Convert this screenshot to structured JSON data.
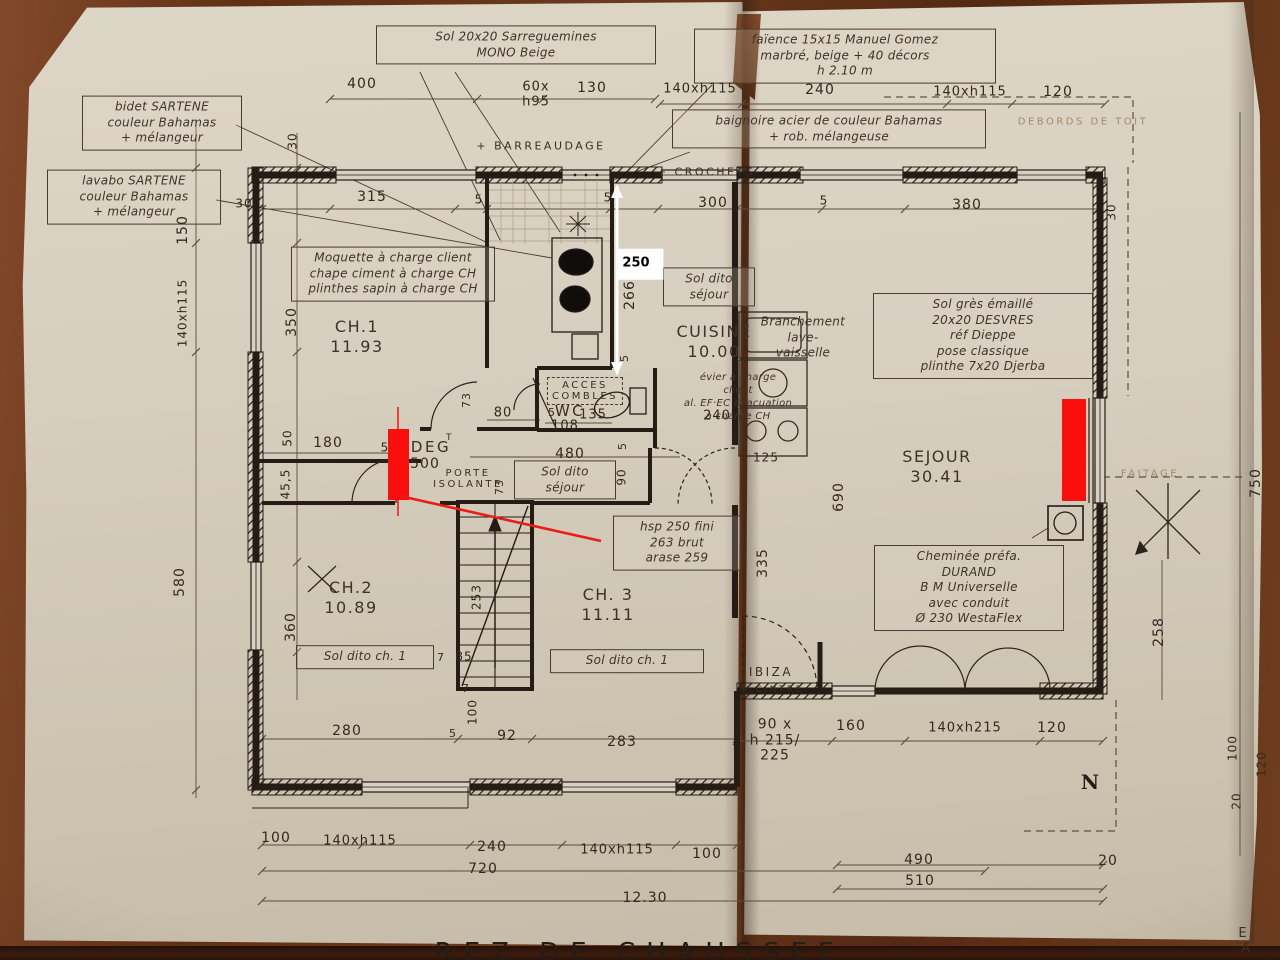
{
  "colors": {
    "ink": "#241c15",
    "paper": "#d6cebe",
    "wood": "#6b3a1d",
    "red": "#fb0f0c",
    "white": "#ffffff"
  },
  "labels": [
    {
      "t": "Sol 20x20  Sarreguemines\nMONO  Beige",
      "x": 516,
      "y": 45,
      "w": 268,
      "cls": "hand box",
      "n": "note-sol-sarreguemines"
    },
    {
      "t": "bidet  SARTENE\ncouleur  Bahamas\n+ mélangeur",
      "x": 162,
      "y": 123,
      "w": 148,
      "cls": "hand box",
      "n": "note-bidet"
    },
    {
      "t": "lavabo  SARTENE\ncouleur  Bahamas\n+ mélangeur",
      "x": 134,
      "y": 197,
      "w": 162,
      "cls": "hand box",
      "n": "note-lavabo"
    },
    {
      "t": "faïence  15x15   Manuel Gomez\nmarbré, beige   + 40 décors\nh 2.10 m",
      "x": 845,
      "y": 56,
      "w": 290,
      "cls": "hand box",
      "n": "note-faience"
    },
    {
      "t": "baignoire  acier  de couleur  Bahamas\n+ rob. mélangeuse",
      "x": 829,
      "y": 129,
      "w": 302,
      "cls": "hand box",
      "n": "note-baignoire"
    },
    {
      "t": "Moquette à charge client\nchape ciment à charge CH\nplinthes sapin à charge CH",
      "x": 393,
      "y": 274,
      "w": 192,
      "cls": "hand box",
      "n": "note-moquette"
    },
    {
      "t": "Sol dito\nséjour",
      "x": 709,
      "y": 287,
      "w": 80,
      "cls": "hand box",
      "n": "note-sol-dito-sejour-cuisine"
    },
    {
      "t": "Sol grès émaillé\n20x20  DESVRES\nréf  Dieppe\npose  classique\nplinthe  7x20  Djerba",
      "x": 983,
      "y": 336,
      "w": 208,
      "cls": "hand box",
      "n": "note-sol-gres"
    },
    {
      "t": "Cheminée  préfa.\nDURAND\nB M   Universelle\navec  conduit\nØ 230   WestaFlex",
      "x": 969,
      "y": 588,
      "w": 178,
      "cls": "hand box",
      "n": "note-cheminee"
    },
    {
      "t": "Sol dito\nséjour",
      "x": 565,
      "y": 480,
      "w": 90,
      "cls": "hand box",
      "n": "note-sol-dito-sejour-deg"
    },
    {
      "t": "Sol dito ch. 1",
      "x": 365,
      "y": 657,
      "w": 126,
      "cls": "hand box",
      "n": "note-sol-dito-ch2"
    },
    {
      "t": "Sol dito ch. 1",
      "x": 627,
      "y": 661,
      "w": 142,
      "cls": "hand box",
      "n": "note-sol-dito-ch3"
    },
    {
      "t": "hsp 250 fini\n263 brut\narase 259",
      "x": 677,
      "y": 543,
      "w": 116,
      "cls": "hand box",
      "n": "note-hauteurs"
    },
    {
      "t": "Branchement\nlave-\nvaisselle",
      "x": 803,
      "y": 338,
      "cls": "hand",
      "n": "note-lave-vaisselle"
    },
    {
      "t": "évier à charge\nclient\nal. EF·EC évacuation\nà charge CH",
      "x": 738,
      "y": 397,
      "cls": "hand",
      "fs": 10,
      "n": "note-evier"
    },
    {
      "t": "+ BARREAUDAGE",
      "x": 541,
      "y": 146,
      "cls": "print",
      "n": "note-barreaudage"
    },
    {
      "t": "+ CROCHETS",
      "x": 706,
      "y": 172,
      "cls": "print",
      "n": "note-crochets"
    },
    {
      "t": "ACCES\nCOMBLES",
      "x": 585,
      "y": 391,
      "cls": "print dashedbox",
      "fs": 10,
      "n": "note-acces-combles"
    },
    {
      "t": "WC",
      "x": 570,
      "y": 411,
      "cls": "print",
      "fs": 15,
      "n": "room-wc"
    },
    {
      "t": "DEG",
      "x": 431,
      "y": 447,
      "cls": "print",
      "fs": 15,
      "n": "room-deg"
    },
    {
      "t": "T",
      "x": 450,
      "y": 438,
      "cls": "print",
      "fs": 9,
      "n": "room-deg-sup"
    },
    {
      "t": "PORTE\nISOLANTE",
      "x": 468,
      "y": 479,
      "cls": "print",
      "fs": 10,
      "n": "note-porte-isolante"
    },
    {
      "t": "DEBORDS  DE  TOIT",
      "x": 1083,
      "y": 122,
      "cls": "print faint",
      "fs": 10,
      "n": "note-debords-de-toit"
    },
    {
      "t": "FAITAGE",
      "x": 1150,
      "y": 474,
      "cls": "print faint",
      "fs": 10,
      "n": "note-faitage"
    },
    {
      "t": "IBIZA",
      "x": 771,
      "y": 672,
      "cls": "print",
      "fs": 12,
      "n": "note-ibiza"
    },
    {
      "t": "+ CINTRE",
      "x": 772,
      "y": 690,
      "cls": "print",
      "fs": 9,
      "n": "note-cintre"
    },
    {
      "t": "E. A",
      "x": 1247,
      "y": 941,
      "cls": "print",
      "fs": 13,
      "n": "corner-initials"
    },
    {
      "t": "CH.1\n11.93",
      "x": 357,
      "y": 337,
      "cls": "room",
      "n": "room-ch1"
    },
    {
      "t": "CUISINE\n10.00",
      "x": 714,
      "y": 342,
      "cls": "room",
      "n": "room-cuisine"
    },
    {
      "t": "SEJOUR\n30.41",
      "x": 937,
      "y": 467,
      "cls": "room",
      "n": "room-sejour"
    },
    {
      "t": "CH.2\n10.89",
      "x": 351,
      "y": 598,
      "cls": "room",
      "n": "room-ch2"
    },
    {
      "t": "CH. 3\n11.11",
      "x": 608,
      "y": 605,
      "cls": "room",
      "n": "room-ch3"
    },
    {
      "t": "N",
      "x": 1090,
      "y": 782,
      "cls": "north",
      "n": "north-indicator"
    },
    {
      "t": "REZ  DE  CHAUSSEE",
      "x": 640,
      "y": 953,
      "cls": "title",
      "n": "drawing-title"
    },
    {
      "t": "250",
      "x": 640,
      "y": 264,
      "cls": "whitetag",
      "n": "measurement-tag-250"
    },
    {
      "t": "400",
      "x": 362,
      "y": 85,
      "cls": "dim"
    },
    {
      "t": "60x",
      "x": 536,
      "y": 88,
      "cls": "dim",
      "fs": 13
    },
    {
      "t": "h95",
      "x": 536,
      "y": 103,
      "cls": "dim",
      "fs": 13
    },
    {
      "t": "130",
      "x": 592,
      "y": 89,
      "cls": "dim"
    },
    {
      "t": "140xh115",
      "x": 700,
      "y": 90,
      "cls": "dim",
      "fs": 13
    },
    {
      "t": "240",
      "x": 820,
      "y": 91,
      "cls": "dim"
    },
    {
      "t": "140xh115",
      "x": 970,
      "y": 93,
      "cls": "dim",
      "fs": 13
    },
    {
      "t": "120",
      "x": 1058,
      "y": 93,
      "cls": "dim"
    },
    {
      "t": "315",
      "x": 372,
      "y": 198,
      "cls": "dim"
    },
    {
      "t": "5",
      "x": 479,
      "y": 200,
      "cls": "dim",
      "fs": 12
    },
    {
      "t": "5",
      "x": 608,
      "y": 198,
      "cls": "dim",
      "fs": 12
    },
    {
      "t": "300",
      "x": 713,
      "y": 204,
      "cls": "dim"
    },
    {
      "t": "5",
      "x": 824,
      "y": 201,
      "cls": "dim",
      "fs": 12
    },
    {
      "t": "380",
      "x": 967,
      "y": 206,
      "cls": "dim"
    },
    {
      "t": "30",
      "x": 244,
      "y": 204,
      "cls": "dim",
      "fs": 12
    },
    {
      "t": "180",
      "x": 328,
      "y": 444,
      "cls": "dim"
    },
    {
      "t": "5",
      "x": 385,
      "y": 448,
      "cls": "dim",
      "fs": 12
    },
    {
      "t": "500",
      "x": 425,
      "y": 465,
      "cls": "dim"
    },
    {
      "t": "80",
      "x": 503,
      "y": 414,
      "cls": "dim",
      "fs": 13
    },
    {
      "t": "5",
      "x": 552,
      "y": 413,
      "cls": "dim",
      "fs": 11
    },
    {
      "t": "135",
      "x": 593,
      "y": 416,
      "cls": "dim",
      "fs": 13
    },
    {
      "t": "108",
      "x": 565,
      "y": 427,
      "cls": "dim",
      "fs": 13
    },
    {
      "t": "480",
      "x": 570,
      "y": 455,
      "cls": "dim"
    },
    {
      "t": "240",
      "x": 717,
      "y": 417,
      "cls": "dim",
      "fs": 13
    },
    {
      "t": "125",
      "x": 766,
      "y": 458,
      "cls": "dim",
      "fs": 12
    },
    {
      "t": "7",
      "x": 441,
      "y": 658,
      "cls": "dim",
      "fs": 11
    },
    {
      "t": "85",
      "x": 464,
      "y": 657,
      "cls": "dim",
      "fs": 12
    },
    {
      "t": "7",
      "x": 466,
      "y": 689,
      "cls": "dim",
      "fs": 11
    },
    {
      "t": "280",
      "x": 347,
      "y": 732,
      "cls": "dim"
    },
    {
      "t": "5",
      "x": 453,
      "y": 734,
      "cls": "dim",
      "fs": 11
    },
    {
      "t": "92",
      "x": 507,
      "y": 737,
      "cls": "dim"
    },
    {
      "t": "283",
      "x": 622,
      "y": 743,
      "cls": "dim"
    },
    {
      "t": "90 x\nh 215/\n225",
      "x": 775,
      "y": 741,
      "cls": "dim",
      "fs": 14
    },
    {
      "t": "160",
      "x": 851,
      "y": 727,
      "cls": "dim"
    },
    {
      "t": "140xh215",
      "x": 965,
      "y": 729,
      "cls": "dim",
      "fs": 13
    },
    {
      "t": "120",
      "x": 1052,
      "y": 729,
      "cls": "dim"
    },
    {
      "t": "100",
      "x": 276,
      "y": 839,
      "cls": "dim"
    },
    {
      "t": "140xh115",
      "x": 360,
      "y": 842,
      "cls": "dim",
      "fs": 13
    },
    {
      "t": "240",
      "x": 492,
      "y": 848,
      "cls": "dim"
    },
    {
      "t": "140xh115",
      "x": 617,
      "y": 851,
      "cls": "dim",
      "fs": 13
    },
    {
      "t": "100",
      "x": 707,
      "y": 855,
      "cls": "dim"
    },
    {
      "t": "720",
      "x": 483,
      "y": 870,
      "cls": "dim"
    },
    {
      "t": "12.30",
      "x": 645,
      "y": 899,
      "cls": "dim"
    },
    {
      "t": "490",
      "x": 919,
      "y": 861,
      "cls": "dim"
    },
    {
      "t": "510",
      "x": 920,
      "y": 882,
      "cls": "dim"
    },
    {
      "t": "20",
      "x": 1108,
      "y": 862,
      "cls": "dim"
    },
    {
      "t": "30",
      "x": 293,
      "y": 141,
      "cls": "dim v",
      "fs": 12
    },
    {
      "t": "150",
      "x": 184,
      "y": 230,
      "cls": "dim v"
    },
    {
      "t": "140xh115",
      "x": 183,
      "y": 313,
      "cls": "dim v",
      "fs": 12
    },
    {
      "t": "350",
      "x": 293,
      "y": 322,
      "cls": "dim v"
    },
    {
      "t": "50",
      "x": 288,
      "y": 438,
      "cls": "dim v",
      "fs": 12
    },
    {
      "t": "45,5",
      "x": 286,
      "y": 484,
      "cls": "dim v",
      "fs": 12
    },
    {
      "t": "580",
      "x": 181,
      "y": 582,
      "cls": "dim v"
    },
    {
      "t": "360",
      "x": 292,
      "y": 627,
      "cls": "dim v"
    },
    {
      "t": "73",
      "x": 467,
      "y": 400,
      "cls": "dim v",
      "fs": 11
    },
    {
      "t": "73",
      "x": 500,
      "y": 487,
      "cls": "dim v",
      "fs": 11
    },
    {
      "t": "5",
      "x": 623,
      "y": 446,
      "cls": "dim v",
      "fs": 11
    },
    {
      "t": "90",
      "x": 622,
      "y": 477,
      "cls": "dim v",
      "fs": 12
    },
    {
      "t": "266",
      "x": 631,
      "y": 295,
      "cls": "dim v"
    },
    {
      "t": "5",
      "x": 625,
      "y": 358,
      "cls": "dim v",
      "fs": 11
    },
    {
      "t": "690",
      "x": 840,
      "y": 497,
      "cls": "dim v"
    },
    {
      "t": "335",
      "x": 764,
      "y": 563,
      "cls": "dim v"
    },
    {
      "t": "750",
      "x": 1257,
      "y": 483,
      "cls": "dim v"
    },
    {
      "t": "258",
      "x": 1160,
      "y": 632,
      "cls": "dim v"
    },
    {
      "t": "253",
      "x": 477,
      "y": 597,
      "cls": "dim v",
      "fs": 12
    },
    {
      "t": "100",
      "x": 473,
      "y": 712,
      "cls": "dim v",
      "fs": 12
    },
    {
      "t": "30",
      "x": 1112,
      "y": 212,
      "cls": "dim v",
      "fs": 12
    },
    {
      "t": "100",
      "x": 1233,
      "y": 748,
      "cls": "dim v",
      "fs": 12
    },
    {
      "t": "120",
      "x": 1262,
      "y": 764,
      "cls": "dim v",
      "fs": 12
    },
    {
      "t": "20",
      "x": 1237,
      "y": 801,
      "cls": "dim v",
      "fs": 12
    }
  ]
}
